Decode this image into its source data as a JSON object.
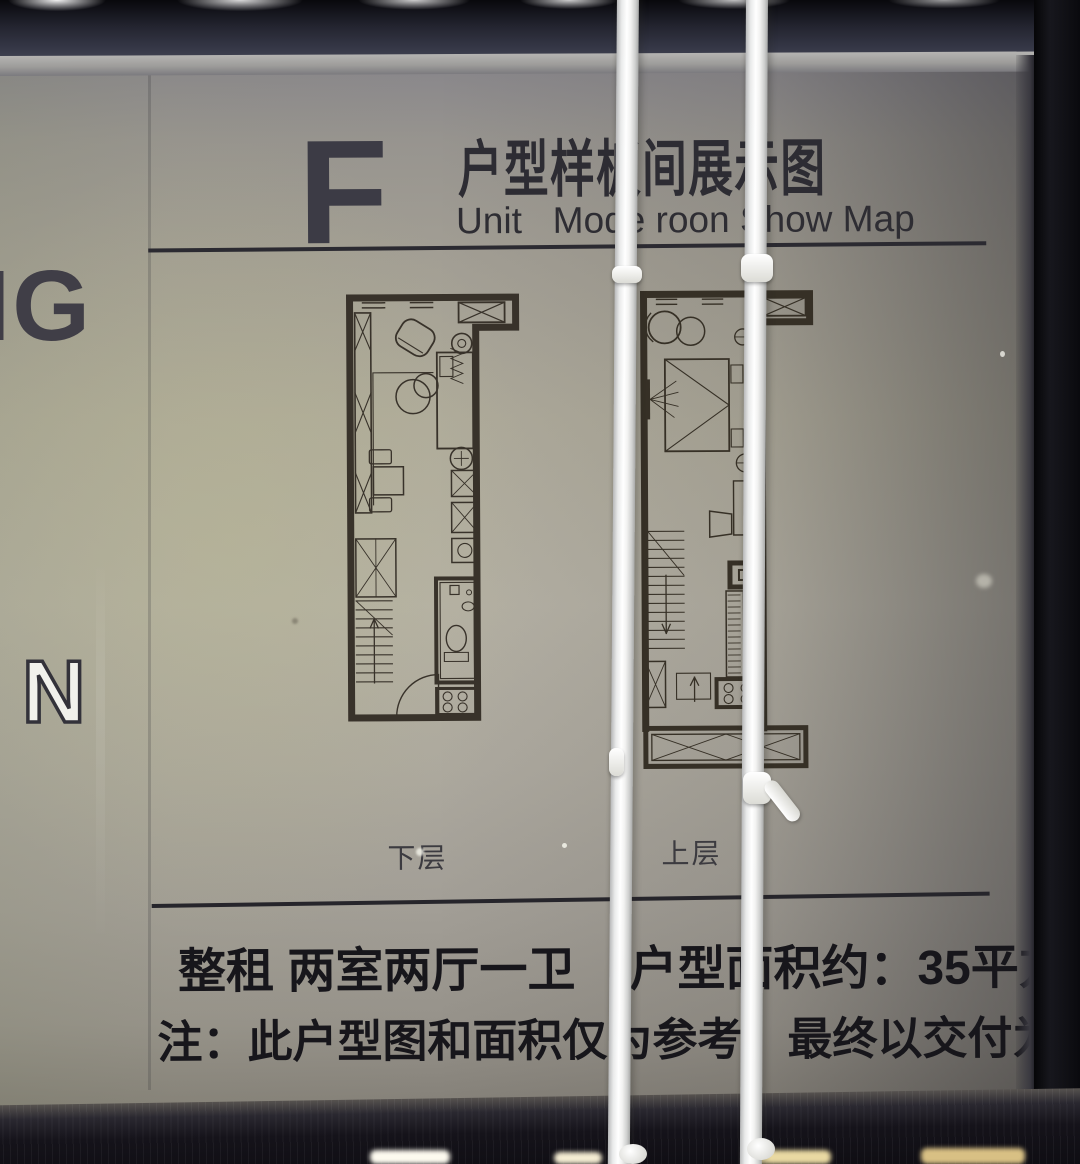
{
  "sign": {
    "unit_letter": "F",
    "title_cn": "户型样板间展示图",
    "title_en": "Unit   Mode roon Show Map",
    "plan_labels": {
      "lower": "下层",
      "upper": "上层"
    },
    "info": {
      "lease_type": "整租 两室两厅一卫",
      "area": "户型面积约：35平方米"
    },
    "note": "注：此户型图和面积仅为参考，最终以交付为准。",
    "partial_text_left": {
      "top": "NG",
      "bottom": "N"
    },
    "colors": {
      "panel": "#b2ae9e",
      "frame_black": "#0c0b10",
      "ink": "#17161b",
      "rule": "#2b2a31",
      "plan_ink": "#38322a",
      "tie_white": "#f5f5f2"
    }
  }
}
